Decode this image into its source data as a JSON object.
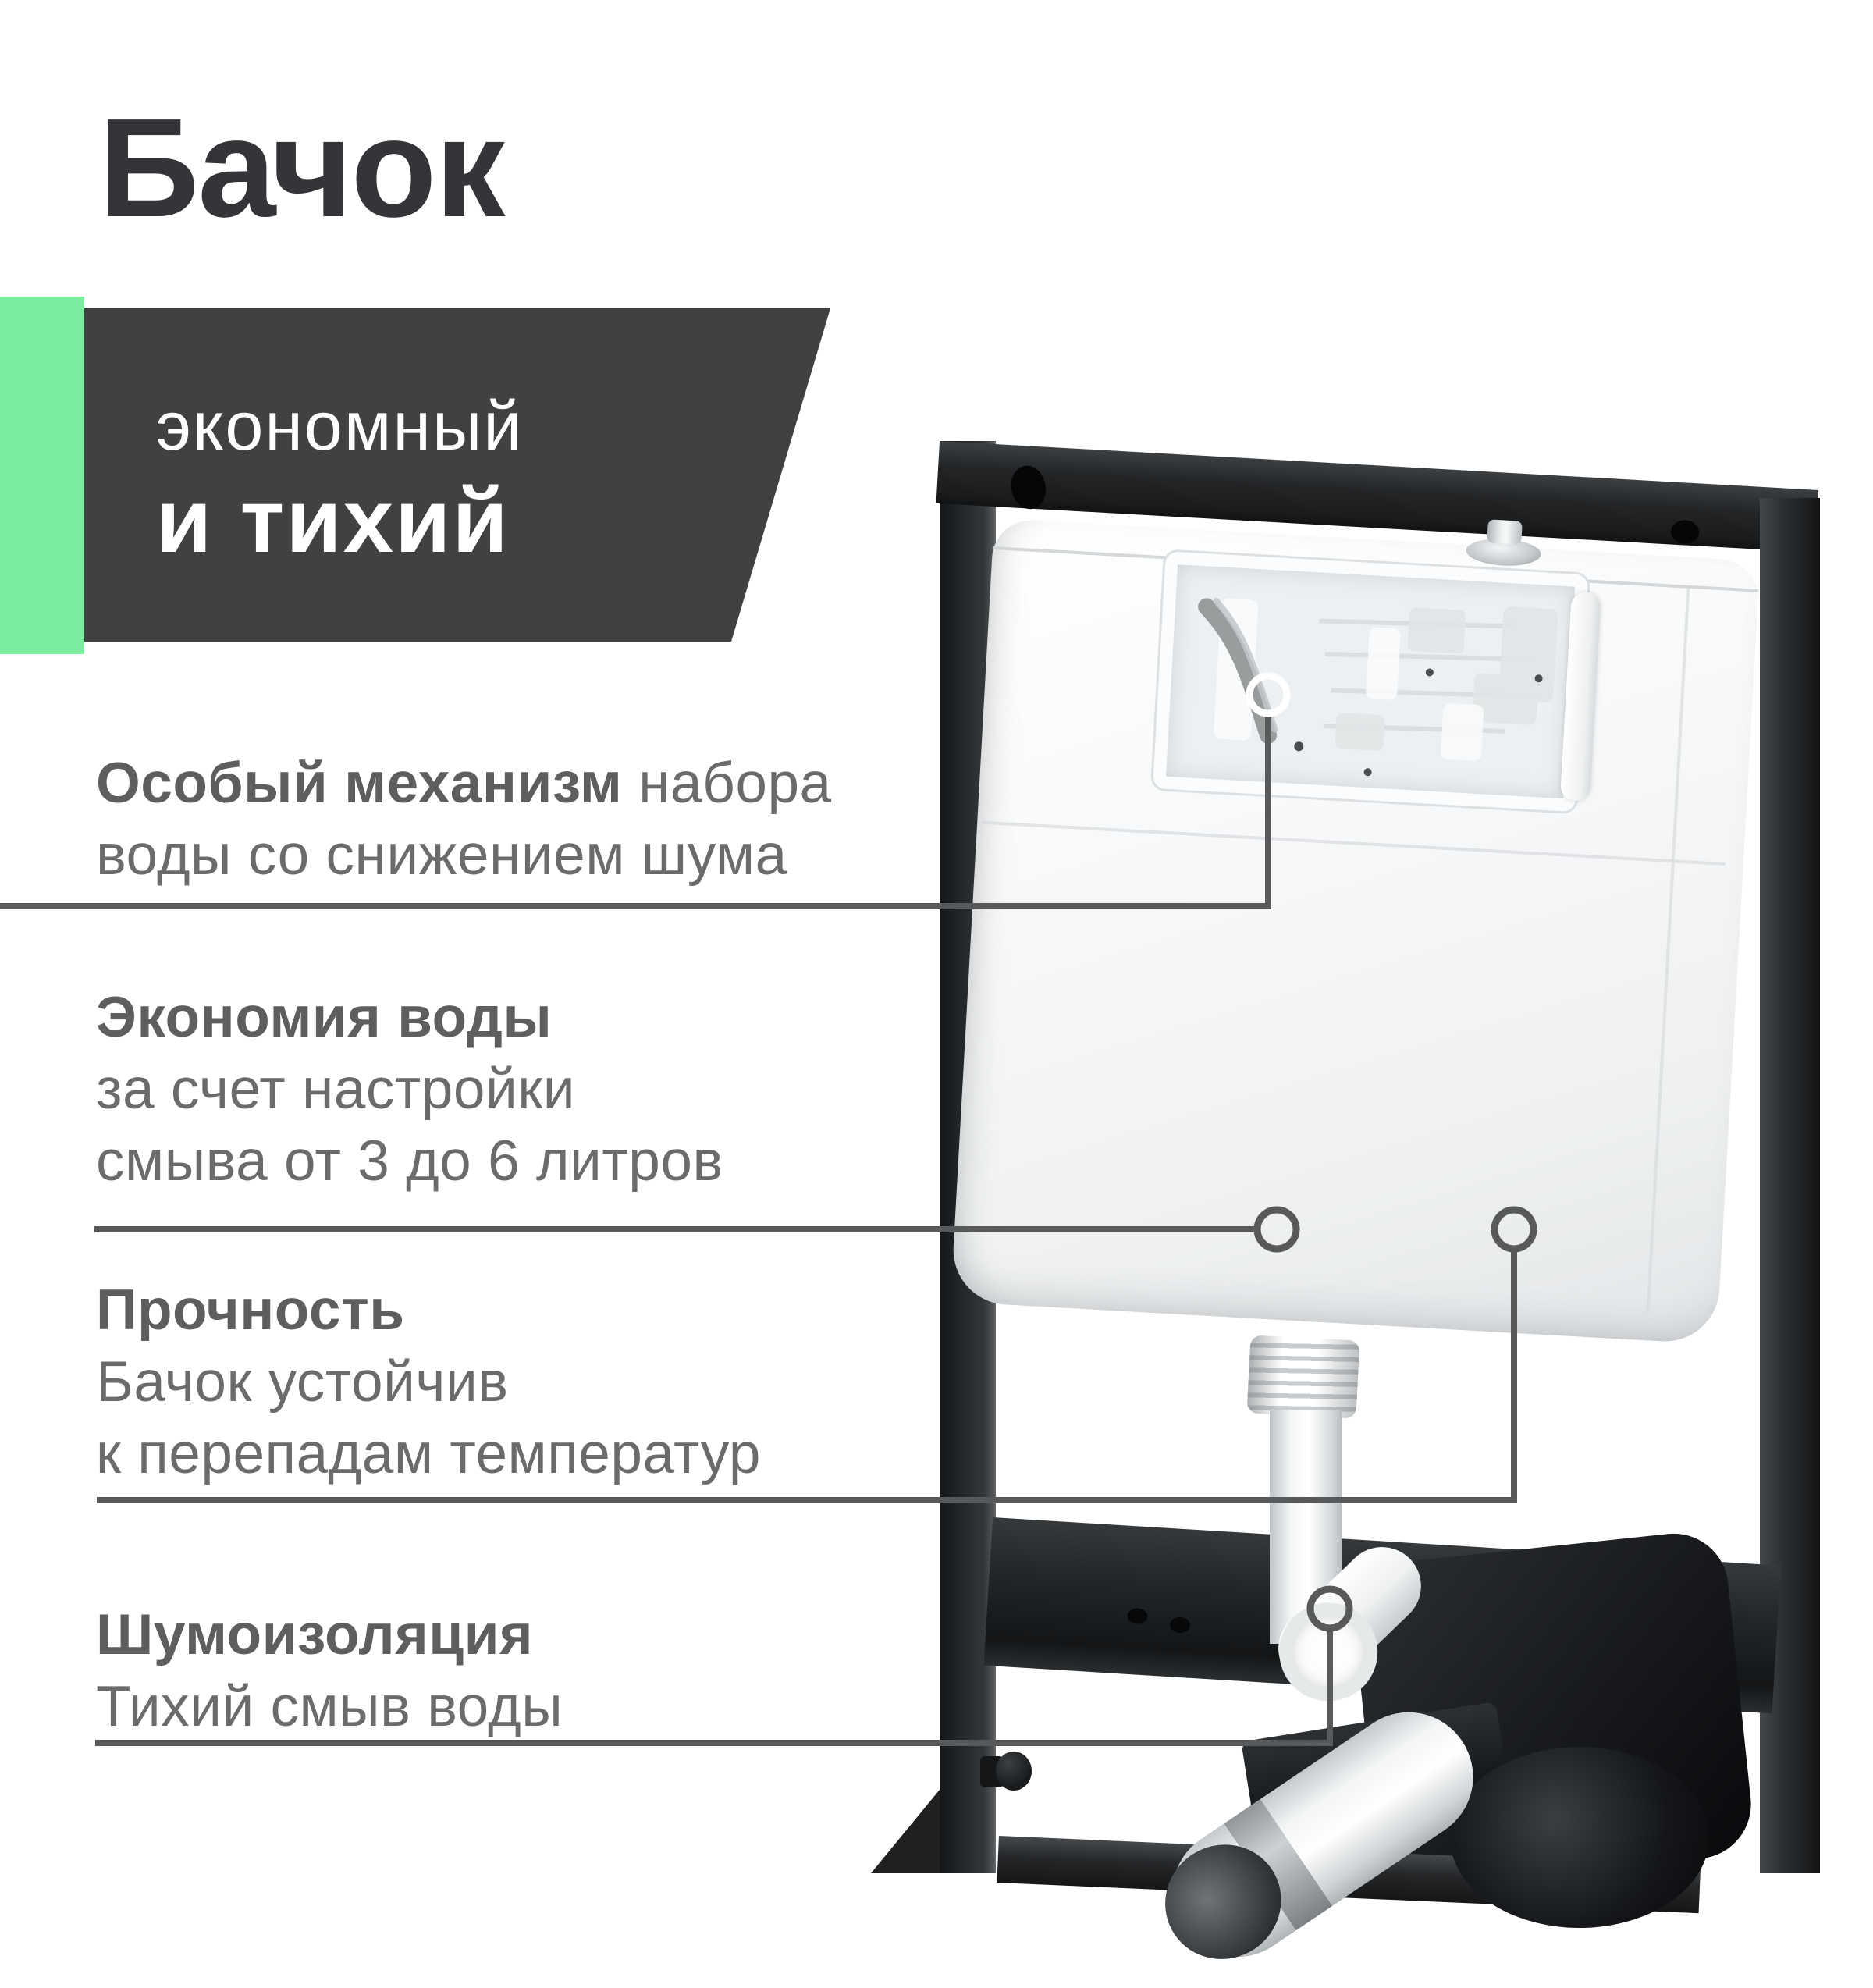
{
  "title": "Бачок",
  "banner": {
    "line1": "экономный",
    "line2": "и тихий"
  },
  "features": [
    {
      "name": "mechanism",
      "lines": [
        [
          {
            "text": "Особый механизм",
            "bold": true
          },
          {
            "text": " набора",
            "bold": false
          }
        ],
        [
          {
            "text": "воды со снижением шума",
            "bold": false
          }
        ]
      ]
    },
    {
      "name": "water-saving",
      "lines": [
        [
          {
            "text": "Экономия воды",
            "bold": true
          }
        ],
        [
          {
            "text": "за счет настройки",
            "bold": false
          }
        ],
        [
          {
            "text": "смыва от 3 до 6 литров",
            "bold": false
          }
        ]
      ]
    },
    {
      "name": "durability",
      "lines": [
        [
          {
            "text": "Прочность",
            "bold": true
          }
        ],
        [
          {
            "text": "Бачок устойчив",
            "bold": false
          }
        ],
        [
          {
            "text": "к перепадам температур",
            "bold": false
          }
        ]
      ]
    },
    {
      "name": "noise-insulation",
      "lines": [
        [
          {
            "text": "Шумоизоляция",
            "bold": true
          }
        ],
        [
          {
            "text": "Тихий смыв воды",
            "bold": false
          }
        ]
      ]
    }
  ],
  "colors": {
    "accent_green": "#7BEC9E",
    "banner_bg": "#414142",
    "banner_text": "#FFFFFF",
    "title_text": "#333538",
    "feature_text": "#6B6B6B",
    "feature_bold_text": "#5D5E60",
    "callout_line": "#58595B",
    "callout_ring_light": "#FFFFFF",
    "frame_black": "#232527",
    "tank_white": "#F7F8F9"
  }
}
